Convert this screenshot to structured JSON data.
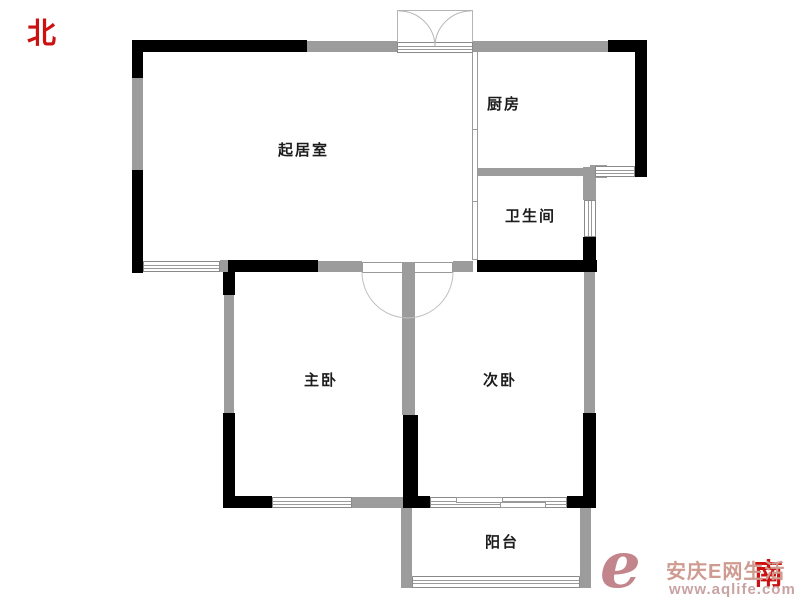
{
  "compass": {
    "north_label": "北",
    "south_label": "南",
    "color": "#cc1111"
  },
  "rooms": {
    "living": "起居室",
    "kitchen": "厨房",
    "bathroom": "卫生间",
    "master_bedroom": "主卧",
    "second_bedroom": "次卧",
    "balcony": "阳台"
  },
  "watermark": {
    "logo_letter": "e",
    "brand_text": "安庆E网生活",
    "website": "www.aqlife.com",
    "logo_color": "#c2858b",
    "brand_color": "#cf9b90",
    "url_color": "#c9a2a2"
  },
  "colors": {
    "wall_solid": "#000000",
    "wall_light": "#9c9c9c",
    "symbol_line": "#b5b5b5",
    "label_text": "#1c1c1c"
  }
}
